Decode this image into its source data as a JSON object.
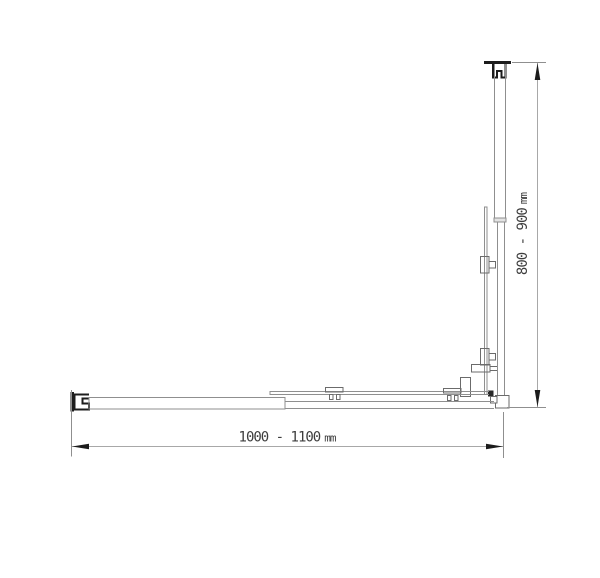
{
  "dimensions": {
    "width": {
      "value": "1000 - 1100",
      "unit": "mm"
    },
    "height": {
      "value": "800 - 900",
      "unit": "mm"
    }
  },
  "colors": {
    "background": "#ffffff",
    "line_light": "#8f8f8f",
    "line_medium": "#6b6b6b",
    "line_dark": "#1c1c1c",
    "dimension_line": "#a8a8a8",
    "text": "#3d3d3d"
  }
}
